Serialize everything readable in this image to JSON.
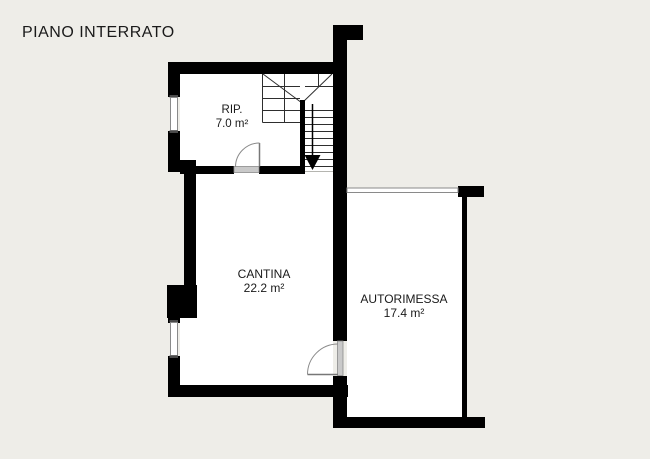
{
  "colors": {
    "bg": "#eeede8",
    "wall": "#000000",
    "room": "#ffffff",
    "line": "#2e2e2e",
    "detail": "#8a8a8a",
    "threshold": "#c9c9c9",
    "text": "#1a1a1a"
  },
  "title": "PIANO INTERRATO",
  "rooms": [
    {
      "name": "RIP.",
      "area": "7.0 m²"
    },
    {
      "name": "CANTINA",
      "area": "22.2 m²"
    },
    {
      "name": "AUTORIMESSA",
      "area": "17.4 m²"
    }
  ]
}
